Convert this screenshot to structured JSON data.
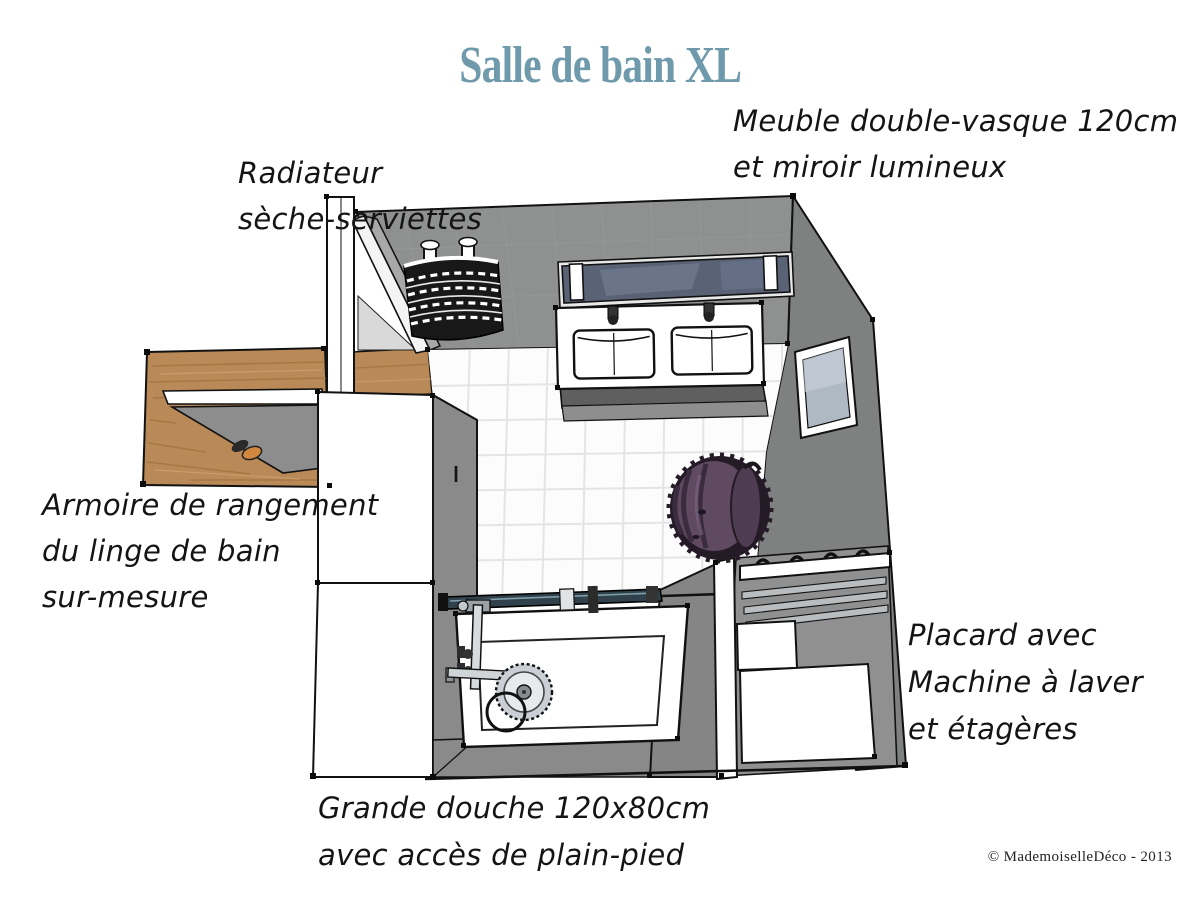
{
  "title": {
    "text": "Salle de bain XL",
    "color": "#6f9aab"
  },
  "annotations": {
    "vanity": {
      "line1": "Meuble double-vasque 120cm",
      "line2": "et miroir lumineux"
    },
    "radiator": {
      "line1": "Radiateur",
      "line2": "sèche-serviettes"
    },
    "armoire": {
      "line1": "Armoire de rangement",
      "line2": "du linge de bain",
      "line3": "sur-mesure"
    },
    "placard": {
      "line1": "Placard avec",
      "line2": "Machine à laver",
      "line3": "et étagères"
    },
    "shower": {
      "line1": "Grande douche 120x80cm",
      "line2": "avec accès de plain-pied"
    }
  },
  "copyright": "© MademoiselleDéco - 2013",
  "colors": {
    "accent_title": "#6f9aab",
    "wall_north": "#8f9090",
    "wall_east": "#7f8080",
    "wall_partition": "#858585",
    "placard_back": "#909090",
    "floor_tile": "#fcfcfc",
    "wood": "#b98a57",
    "mirror_glass": "#5a6375",
    "window_glass": "#aeb9c4",
    "pouf_body": "#604a62",
    "pouf_dark": "#241b27",
    "line_ink": "#121212"
  },
  "scene_icons": {
    "towel_radiator": "towel-radiator-icon",
    "double_sink": "double-sink-icon",
    "mirror": "mirror-icon",
    "window": "window-icon",
    "shower_head": "shower-head-icon",
    "pouf": "pouf-icon",
    "slippers": "slippers-icon"
  }
}
